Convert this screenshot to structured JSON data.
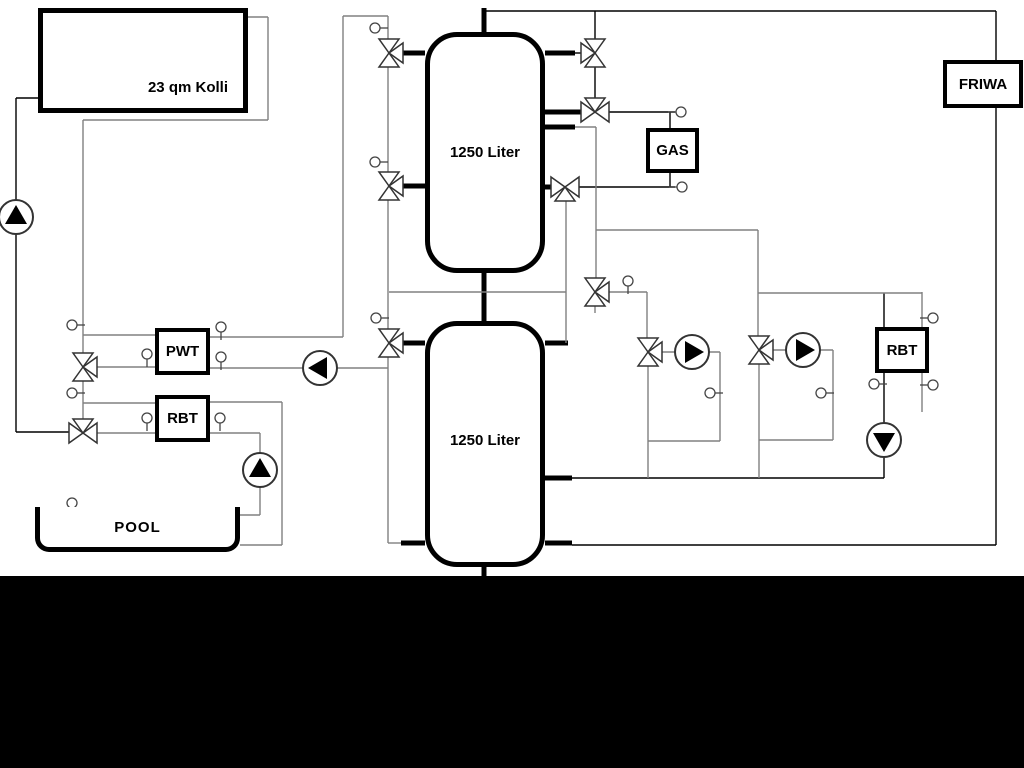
{
  "labels": {
    "collector": "23 qm Kolli",
    "tank_top": "1250 Liter",
    "tank_bottom": "1250 Liter",
    "gas": "GAS",
    "friwa": "FRIWA",
    "pwt": "PWT",
    "rbt_left": "RBT",
    "rbt_right": "RBT",
    "pool": "POOL"
  },
  "colors": {
    "background": "#ffffff",
    "line_black": "#000000",
    "line_gray": "#808080",
    "symbol_stroke": "#333333",
    "pump_fill": "#000000",
    "bottom_band": "#000000"
  },
  "symbols": {
    "pump_icon": "circle with filled flow-direction triangle",
    "three_way_valve_icon": "triangle bowtie valve",
    "sensor_icon": "small circle with stem"
  }
}
